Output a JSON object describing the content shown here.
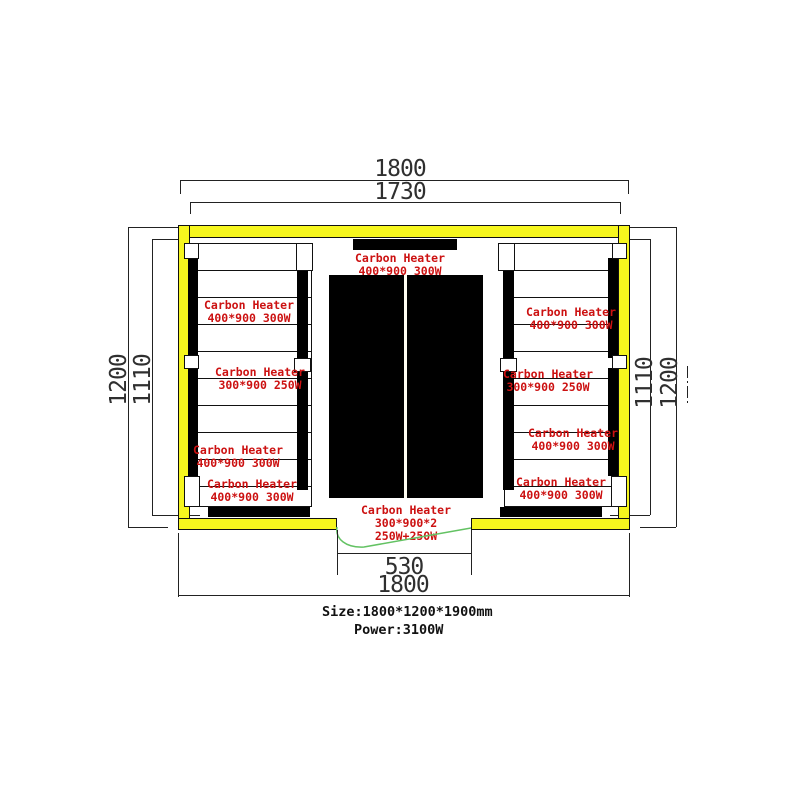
{
  "drawing": {
    "dims": {
      "top_outer": "1800",
      "top_inner": "1730",
      "left_outer": "1200",
      "left_inner": "1110",
      "right_inner": "1110",
      "right_outer": "1200",
      "door": "530",
      "bottom_outer": "1800"
    },
    "heaters": {
      "center_top": {
        "name": "Carbon Heater",
        "spec": "400*900 300W"
      },
      "center_bottom": {
        "name": "Carbon Heater",
        "spec": "300*900*2",
        "power": "250W+250W"
      },
      "left_bench": [
        {
          "name": "Carbon Heater",
          "spec": "400*900 300W"
        },
        {
          "name": "Carbon Heater",
          "spec": "300*900 250W"
        },
        {
          "name": "Carbon Heater",
          "spec": "400*900 300W"
        },
        {
          "name": "Carbon Heater",
          "spec": "400*900 300W"
        }
      ],
      "right_bench": [
        {
          "name": "Carbon Heater",
          "spec": "400*900 300W"
        },
        {
          "name": "Carbon Heater",
          "spec": "300*900 250W"
        },
        {
          "name": "Carbon Heater",
          "spec": "400*900 300W"
        },
        {
          "name": "Carbon Heater",
          "spec": "400*900 300W"
        }
      ]
    },
    "footer": {
      "size": "Size:1800*1200*1900mm",
      "power": "Power:3100W"
    },
    "colors": {
      "wall_yellow": "#f6f61e",
      "heater_red": "#cc1111",
      "leader_green": "#63c263"
    }
  }
}
